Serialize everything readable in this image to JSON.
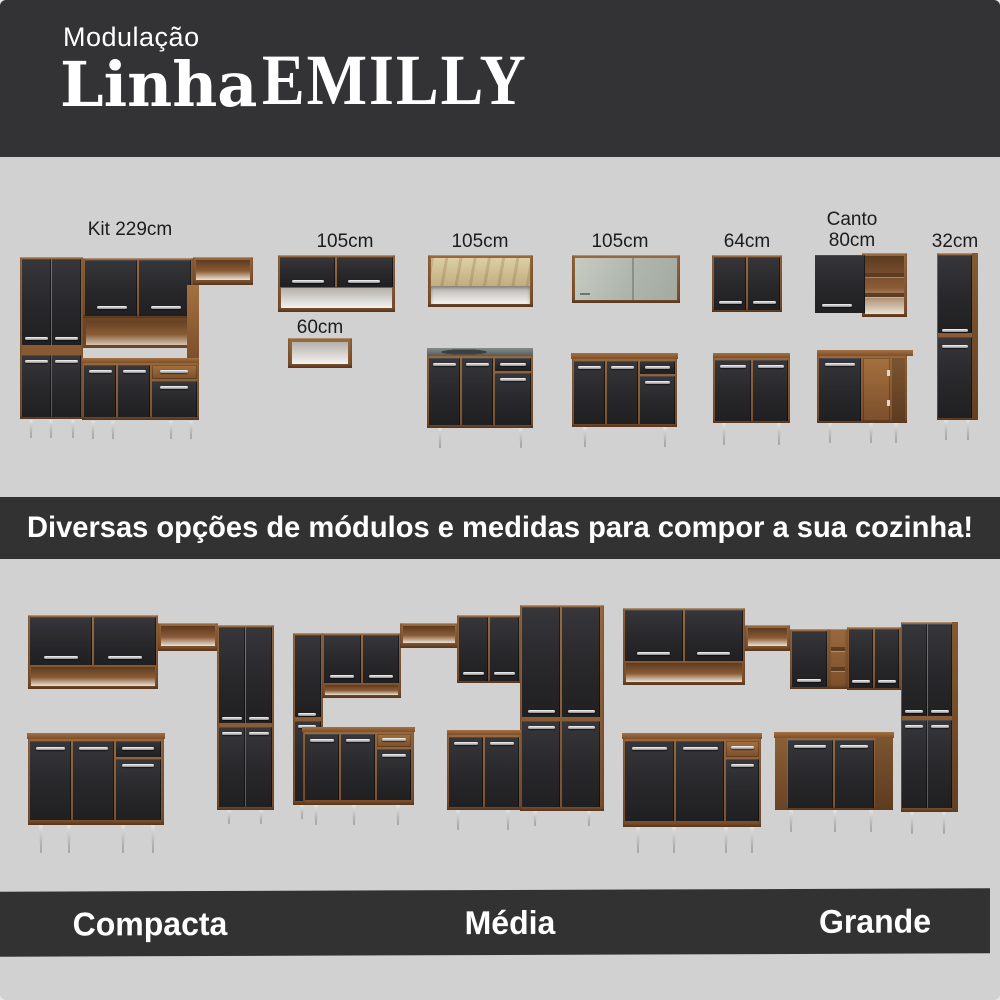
{
  "header": {
    "kicker": "Modulação",
    "title_script": "Linha",
    "title_caps": "EMILLY"
  },
  "modules": [
    {
      "id": "kit-229",
      "label": "Kit 229cm"
    },
    {
      "id": "wall-105",
      "label": "105cm"
    },
    {
      "id": "open-105",
      "label": "105cm"
    },
    {
      "id": "glass-105",
      "label": "105cm"
    },
    {
      "id": "wall-64",
      "label": "64cm"
    },
    {
      "id": "corner-80",
      "label": "Canto\n80cm"
    },
    {
      "id": "tall-32",
      "label": "32cm"
    },
    {
      "id": "shelf-60",
      "label": "60cm"
    }
  ],
  "tagline": "Diversas opções de módulos e medidas para compor a sua cozinha!",
  "sets": [
    {
      "label": "Compacta"
    },
    {
      "label": "Média"
    },
    {
      "label": "Grande"
    }
  ],
  "colors": {
    "header_bg": "#333234",
    "body_bg": "#d1d1d1",
    "band_bg": "#323232",
    "wood": "#8a5c36",
    "door_black": "#28282b",
    "text_light": "#ffffff",
    "text_dark": "#1c1c1c"
  }
}
